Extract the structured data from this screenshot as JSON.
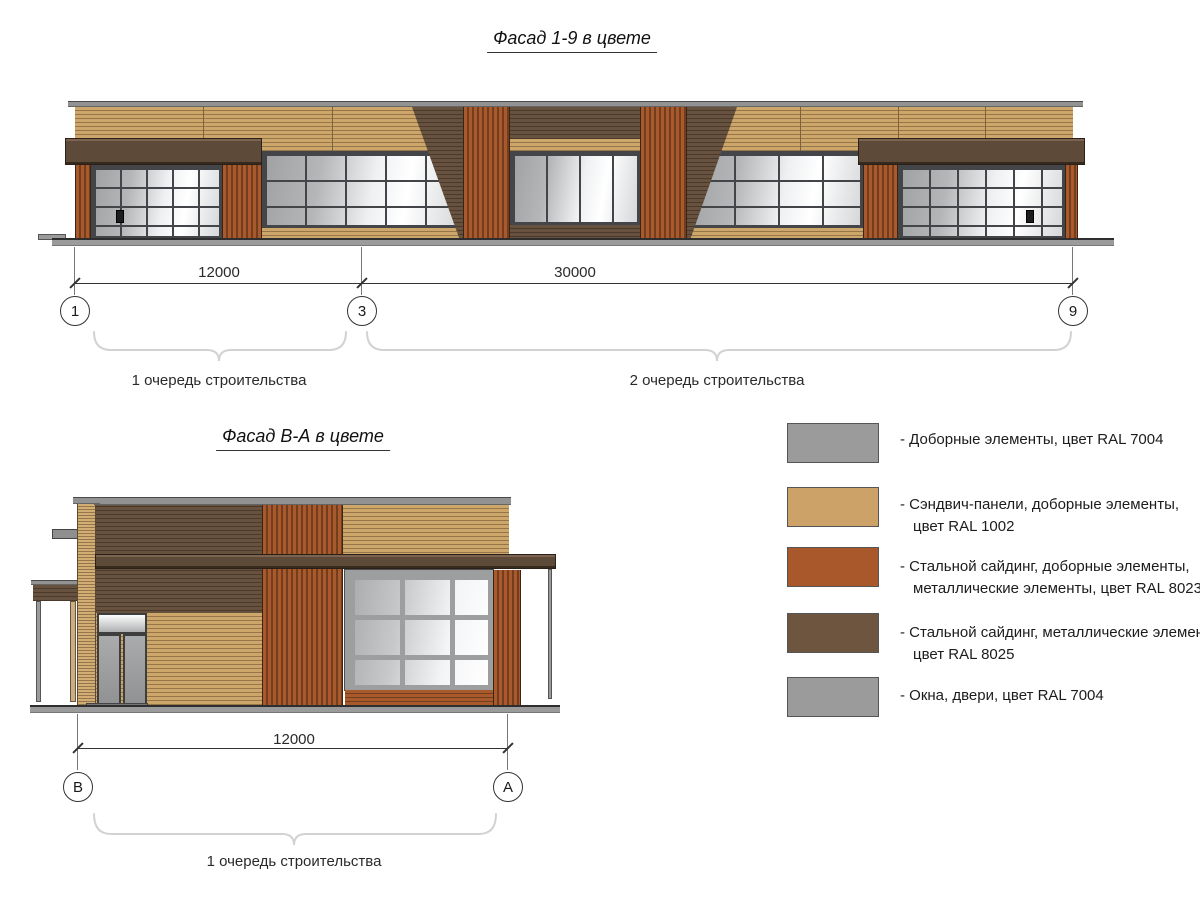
{
  "drawing": {
    "title_top": "Фасад 1-9 в цвете",
    "title_bottom": "Фасад В-А в цвете"
  },
  "top_facade": {
    "dim_12000": "12000",
    "dim_30000": "30000",
    "axis_1": "1",
    "axis_3": "3",
    "axis_9": "9",
    "phase_1": "1 очередь строительства",
    "phase_2": "2 очередь строительства"
  },
  "bottom_facade": {
    "dim_12000": "12000",
    "axis_b": "В",
    "axis_a": "А",
    "phase_1": "1 очередь строительства"
  },
  "legend": {
    "items": [
      {
        "ral": "RAL 7004",
        "color": "#9b9b9b",
        "lines": [
          "- Доборные элементы, цвет RAL 7004"
        ]
      },
      {
        "ral": "RAL 1002",
        "color": "#cda269",
        "lines": [
          "- Сэндвич-панели, доборные элементы,",
          "цвет RAL 1002"
        ]
      },
      {
        "ral": "RAL 8023",
        "color": "#a8582b",
        "lines": [
          "- Стальной сайдинг, доборные элементы,",
          "металлические элементы, цвет RAL 8023"
        ]
      },
      {
        "ral": "RAL 8025",
        "color": "#6e5540",
        "lines": [
          "- Стальной сайдинг, металлические элементы,",
          "цвет RAL 8025"
        ]
      },
      {
        "ral": "RAL 7004",
        "color": "#9b9b9b",
        "lines": [
          "- Окна, двери, цвет RAL 7004"
        ]
      }
    ]
  }
}
